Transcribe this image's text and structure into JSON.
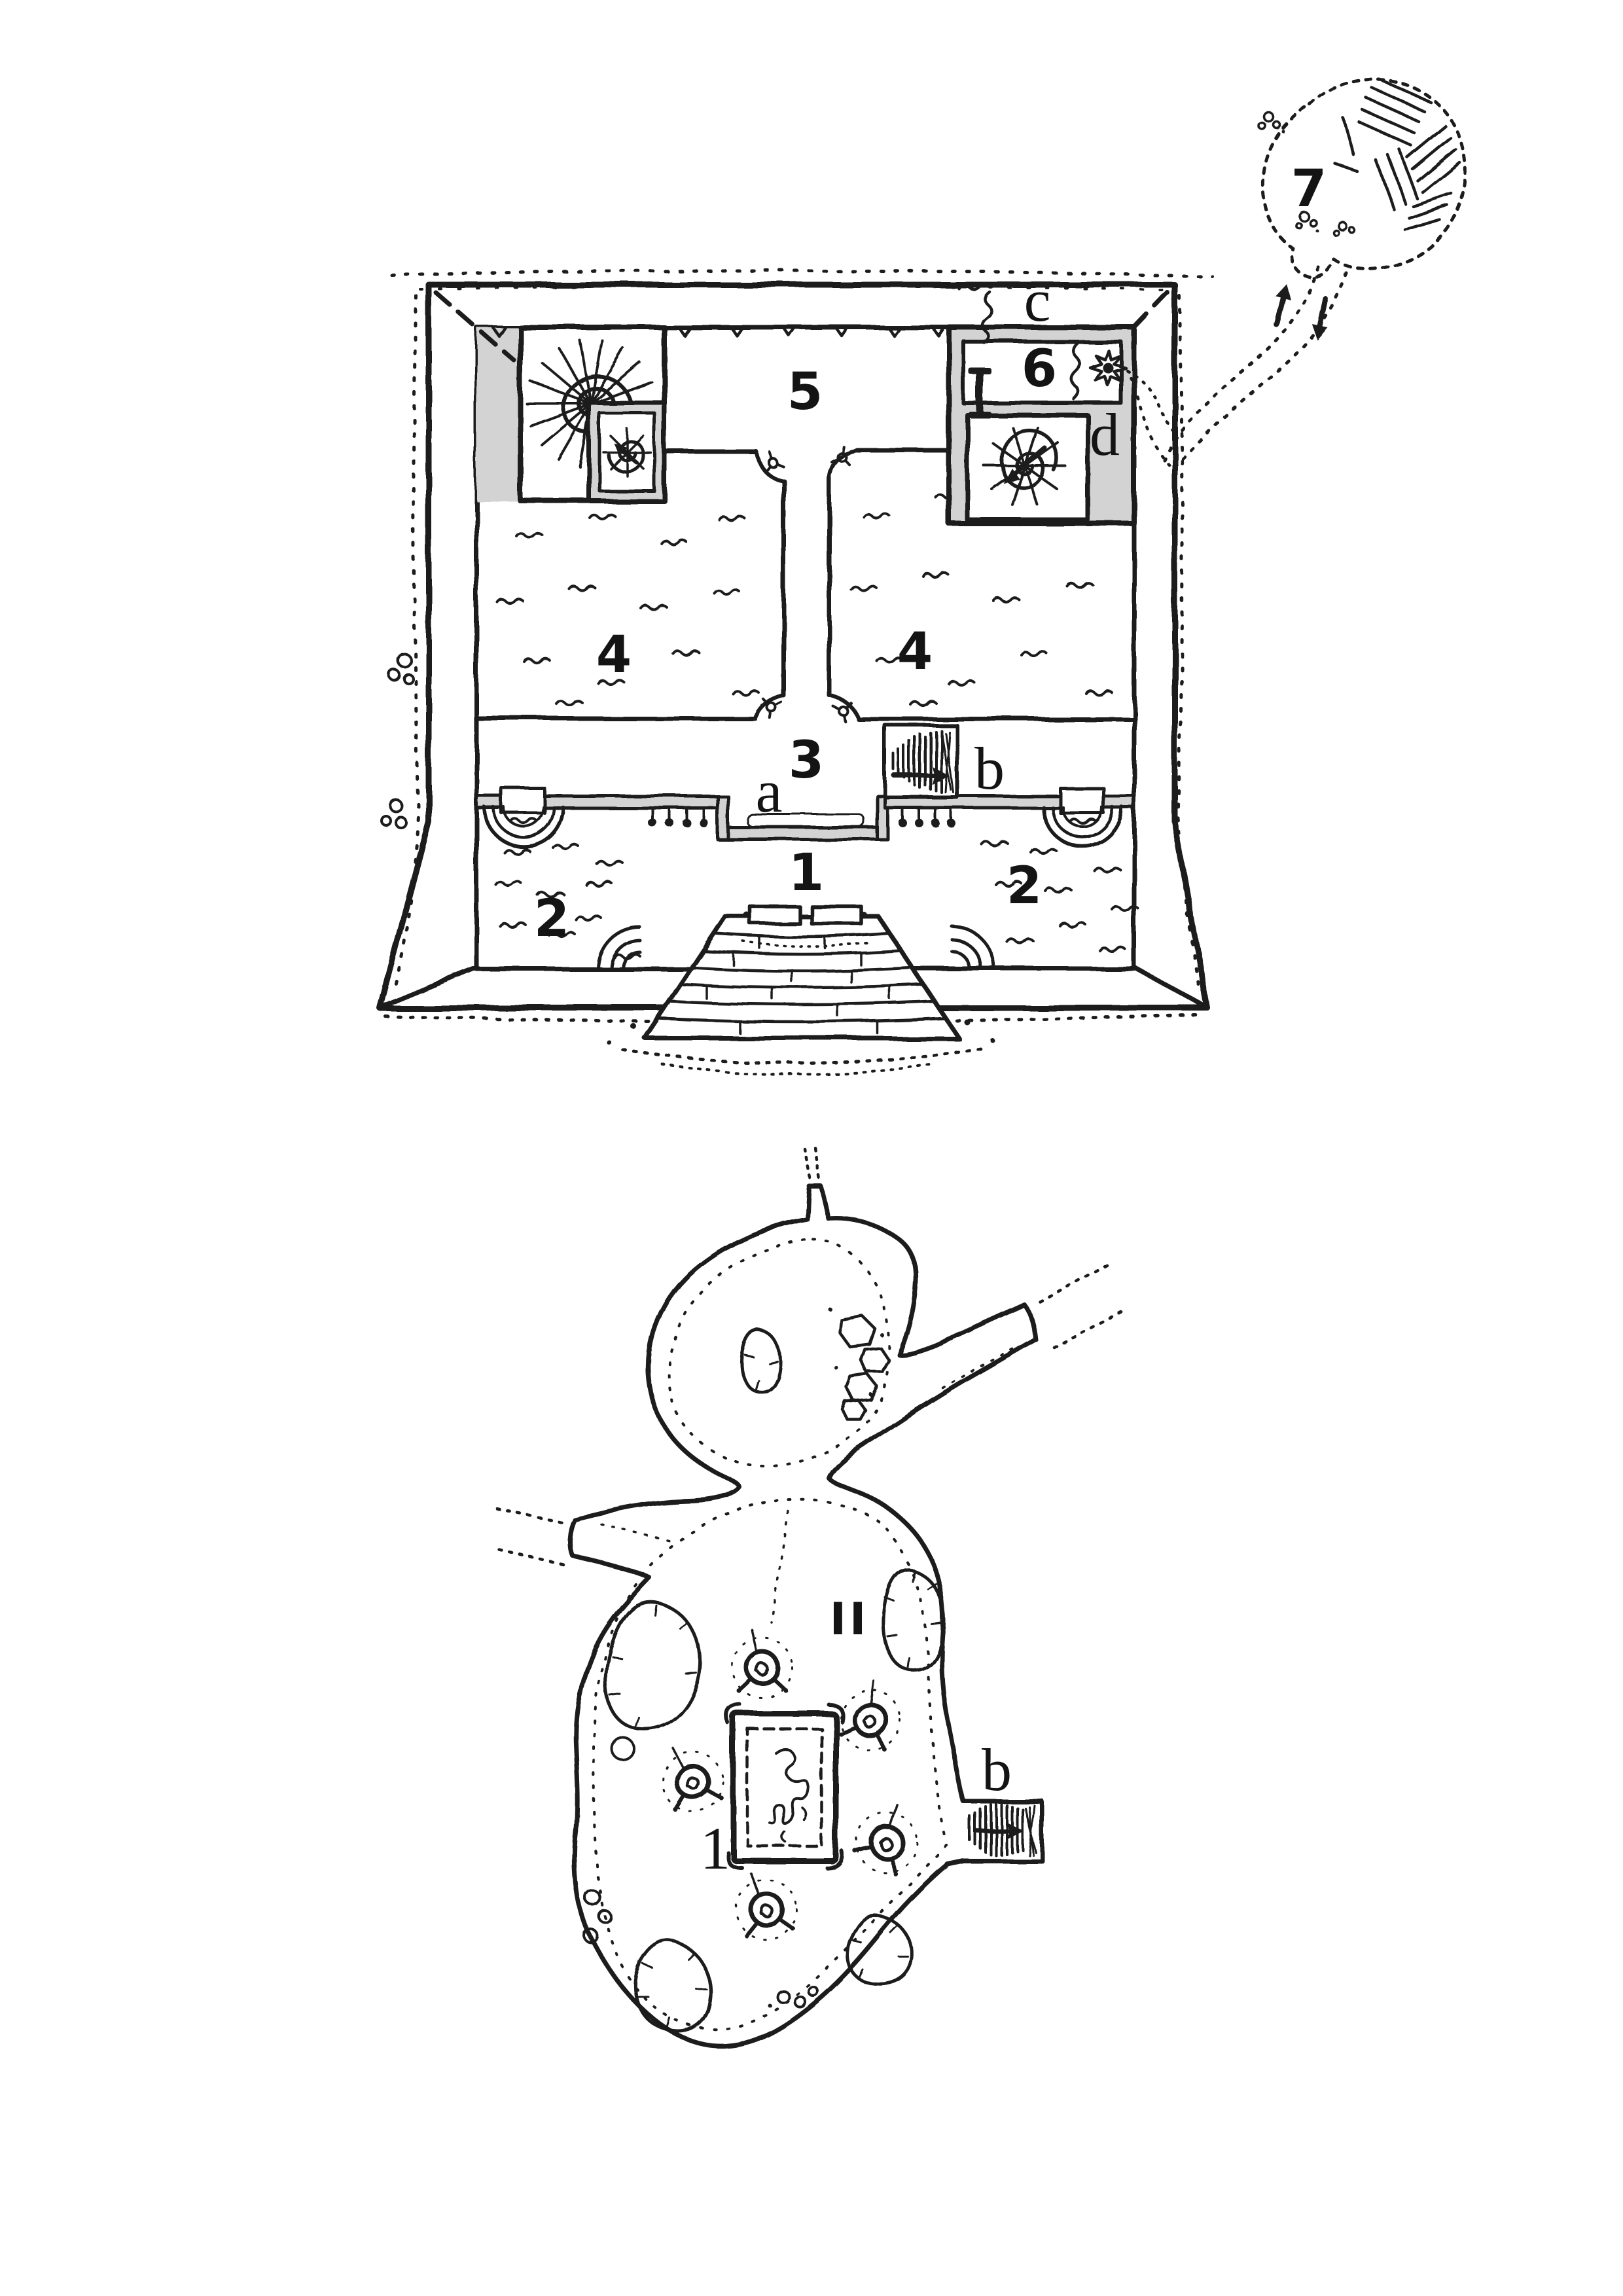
{
  "colors": {
    "paper": "#ffffff",
    "ink": "#1b1b1b",
    "wall_fill": "#d3d3d3"
  },
  "temple_map": {
    "description": "Hand-drawn square temple floor plan with thick grey walls",
    "labels": {
      "room1": "1",
      "room2_left": "2",
      "room2_right": "2",
      "room3": "3",
      "room4_left": "4",
      "room4_right": "4",
      "room5": "5",
      "room6": "6",
      "cave7": "7",
      "feature_a": "a",
      "feature_b": "b",
      "feature_c": "c",
      "feature_d": "d"
    },
    "symbols": [
      "spiral-staircase",
      "secret-passage-squiggle",
      "sunburst",
      "black-altar-bar",
      "stairs-with-arrow",
      "fountain-basin",
      "corner-pool",
      "water-ripples",
      "entrance-steps",
      "double-doors",
      "door-pivots",
      "dotted-trail",
      "rubble-dots",
      "outlying-cave"
    ]
  },
  "cave_map": {
    "description": "Natural cavern level below the temple",
    "labels": {
      "level": "II",
      "feature_1": "1",
      "feature_b": "b"
    },
    "symbols": [
      "tripod-braziers",
      "ceremonial-dais-with-figure",
      "grey-rock-columns",
      "boulder-clusters",
      "stair-passage-with-arrow",
      "dotted-passages",
      "edge-stipple"
    ]
  }
}
